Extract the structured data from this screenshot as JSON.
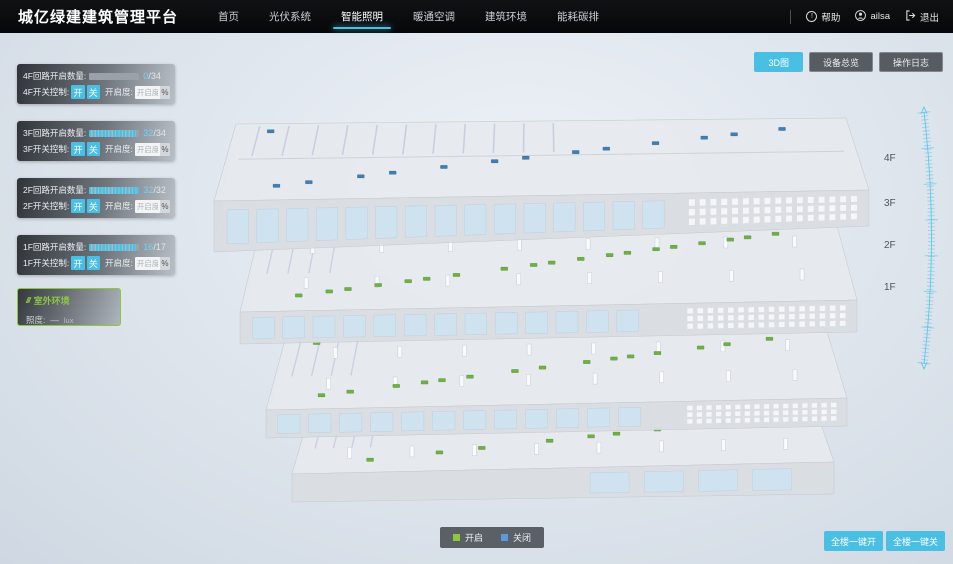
{
  "app": {
    "title": "城亿绿建建筑管理平台"
  },
  "nav": {
    "items": [
      {
        "label": "首页",
        "active": false
      },
      {
        "label": "光伏系统",
        "active": false
      },
      {
        "label": "智能照明",
        "active": true
      },
      {
        "label": "暖通空调",
        "active": false
      },
      {
        "label": "建筑环境",
        "active": false
      },
      {
        "label": "能耗碳排",
        "active": false
      }
    ],
    "help_label": "帮助",
    "help_glyph": "!",
    "user_name": "ailsa",
    "logout_label": "退出"
  },
  "toolbar": {
    "buttons": [
      {
        "label": "3D图",
        "active": true
      },
      {
        "label": "设备总览",
        "active": false
      },
      {
        "label": "操作日志",
        "active": false
      }
    ]
  },
  "floor_panels": [
    {
      "count_label": "4F回路开启数量:",
      "num": "0",
      "den": "/34",
      "pct": 0,
      "switch_label": "4F开关控制:",
      "on_label": "开",
      "off_label": "关",
      "dim_label": "开启度:",
      "dim_placeholder": "开启度",
      "unit": "%"
    },
    {
      "count_label": "3F回路开启数量:",
      "num": "32",
      "den": "/34",
      "pct": 94,
      "switch_label": "3F开关控制:",
      "on_label": "开",
      "off_label": "关",
      "dim_label": "开启度:",
      "dim_placeholder": "开启度",
      "unit": "%"
    },
    {
      "count_label": "2F回路开启数量:",
      "num": "32",
      "den": "/32",
      "pct": 100,
      "switch_label": "2F开关控制:",
      "on_label": "开",
      "off_label": "关",
      "dim_label": "开启度:",
      "dim_placeholder": "开启度",
      "unit": "%"
    },
    {
      "count_label": "1F回路开启数量:",
      "num": "16",
      "den": "/17",
      "pct": 94,
      "switch_label": "1F开关控制:",
      "on_label": "开",
      "off_label": "关",
      "dim_label": "开启度:",
      "dim_placeholder": "开启度",
      "unit": "%"
    }
  ],
  "outdoor": {
    "title": "室外环境",
    "metric_label": "照度:",
    "metric_value": "—",
    "metric_unit": "lux"
  },
  "floor_axis": [
    "4F",
    "3F",
    "2F",
    "1F"
  ],
  "legend": {
    "on_label": "开启",
    "on_color": "#8dc63f",
    "off_label": "关闭",
    "off_color": "#5b9bd5"
  },
  "bulk_buttons": [
    {
      "label": "全楼一键开"
    },
    {
      "label": "全楼一键关"
    }
  ],
  "building": {
    "floors": [
      {
        "name": "4F",
        "marker_color": "#3d7fb8",
        "markers": 14
      },
      {
        "name": "3F",
        "marker_color": "#6cb33e",
        "markers": 20
      },
      {
        "name": "2F",
        "marker_color": "#6cb33e",
        "markers": 16
      },
      {
        "name": "1F",
        "marker_color": "#6cb33e",
        "markers": 10
      }
    ]
  },
  "colors": {
    "accent": "#49bfe4",
    "outdoor_green": "#8dc63f",
    "ruler": "#5ec7ea"
  }
}
